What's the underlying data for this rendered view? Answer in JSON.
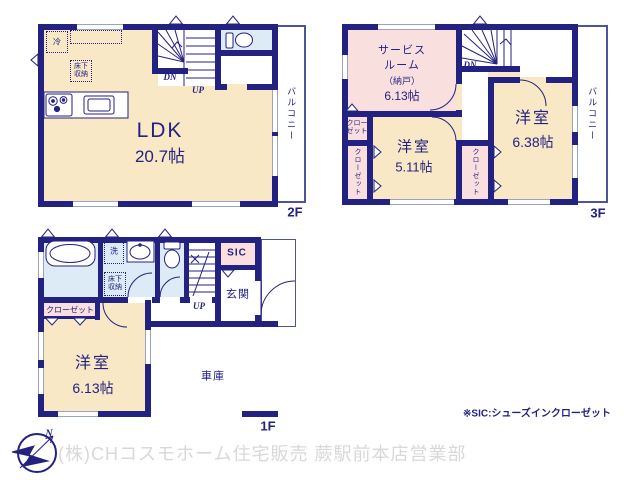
{
  "colors": {
    "wall_navy": "#232280",
    "room_cream": "#f8e8c6",
    "room_pink": "#fadfdf",
    "room_blue": "#dcebf5",
    "window_line": "#9aa2c6",
    "watermark_gray": "#d8d8d8"
  },
  "floor2": {
    "label": "2F",
    "ldk_name": "LDK",
    "ldk_size": "20.7帖",
    "balcony": "バルコニー",
    "dn": "DN",
    "up": "UP",
    "fridge": "冷",
    "underfloor_storage": "床下収納"
  },
  "floor3": {
    "label": "3F",
    "service_line1": "サービス",
    "service_line2": "ルーム",
    "service_line3": "（納戸）",
    "service_size": "6.13帖",
    "dn": "DN",
    "room_a_name": "洋室",
    "room_a_size": "5.11帖",
    "room_b_name": "洋室",
    "room_b_size": "6.38帖",
    "closet": "クローゼット",
    "balcony": "バルコニー"
  },
  "floor1": {
    "label": "1F",
    "room_name": "洋室",
    "room_size": "6.13帖",
    "garage": "車庫",
    "entrance": "玄関",
    "sic": "SIC",
    "closet": "クローゼット",
    "washer": "洗",
    "underfloor_storage": "床下収納",
    "up": "UP"
  },
  "annotations": {
    "sic_note": "※SIC:シューズインクローゼット",
    "company": "(株)CHコスモホーム住宅販売 蕨駅前本店営業部",
    "compass_n": "N"
  }
}
